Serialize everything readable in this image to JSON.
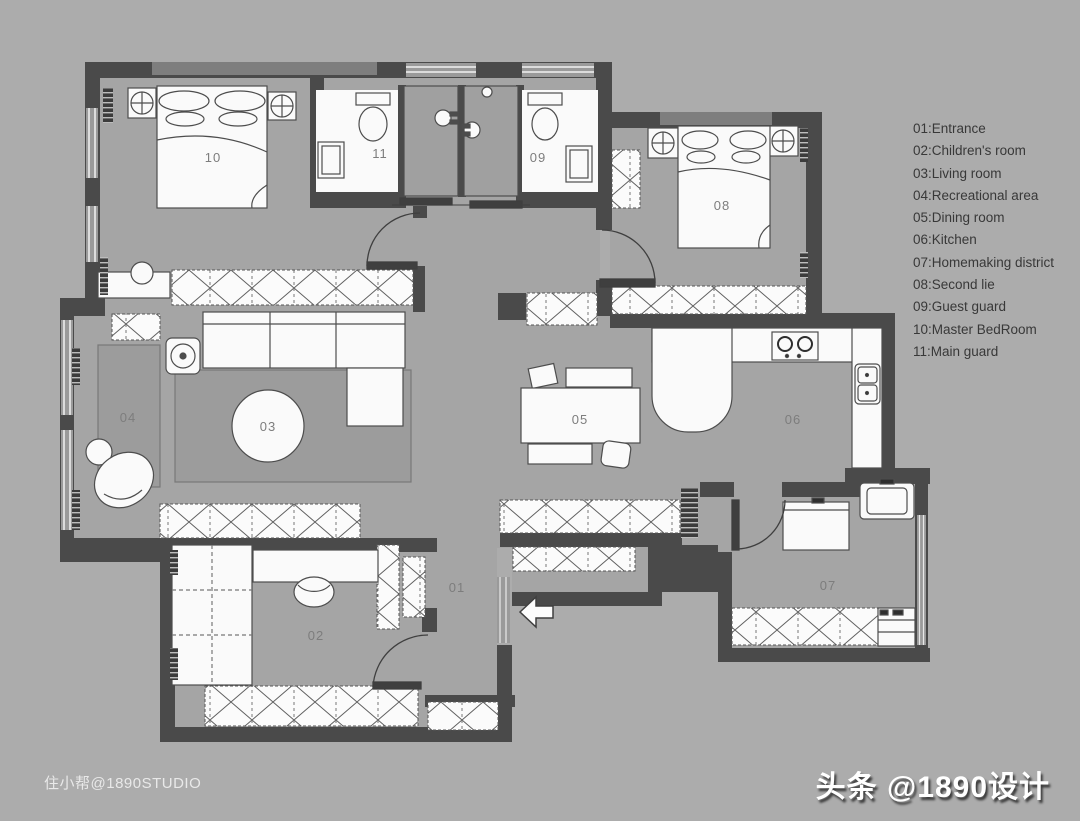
{
  "legend": {
    "items": [
      "01:Entrance",
      "02:Children's room",
      "03:Living room",
      "04:Recreational area",
      "05:Dining room",
      "06:Kitchen",
      "07:Homemaking district",
      "08:Second lie",
      "09:Guest guard",
      "10:Master BedRoom",
      "11:Main guard"
    ]
  },
  "rooms": {
    "r01": "01",
    "r02": "02",
    "r03": "03",
    "r04": "04",
    "r05": "05",
    "r06": "06",
    "r07": "07",
    "r08": "08",
    "r09": "09",
    "r10": "10",
    "r11": "11"
  },
  "watermarks": {
    "left": "住小帮@1890STUDIO",
    "right": "头条 @1890设计"
  },
  "colors": {
    "background": "#acacac",
    "floor": "#a5a5a5",
    "wall": "#4a4a4a",
    "wall_light": "#7e7e7e",
    "furniture": "#fafafa",
    "legend_text": "#383838",
    "room_label": "#7d7d7d"
  }
}
